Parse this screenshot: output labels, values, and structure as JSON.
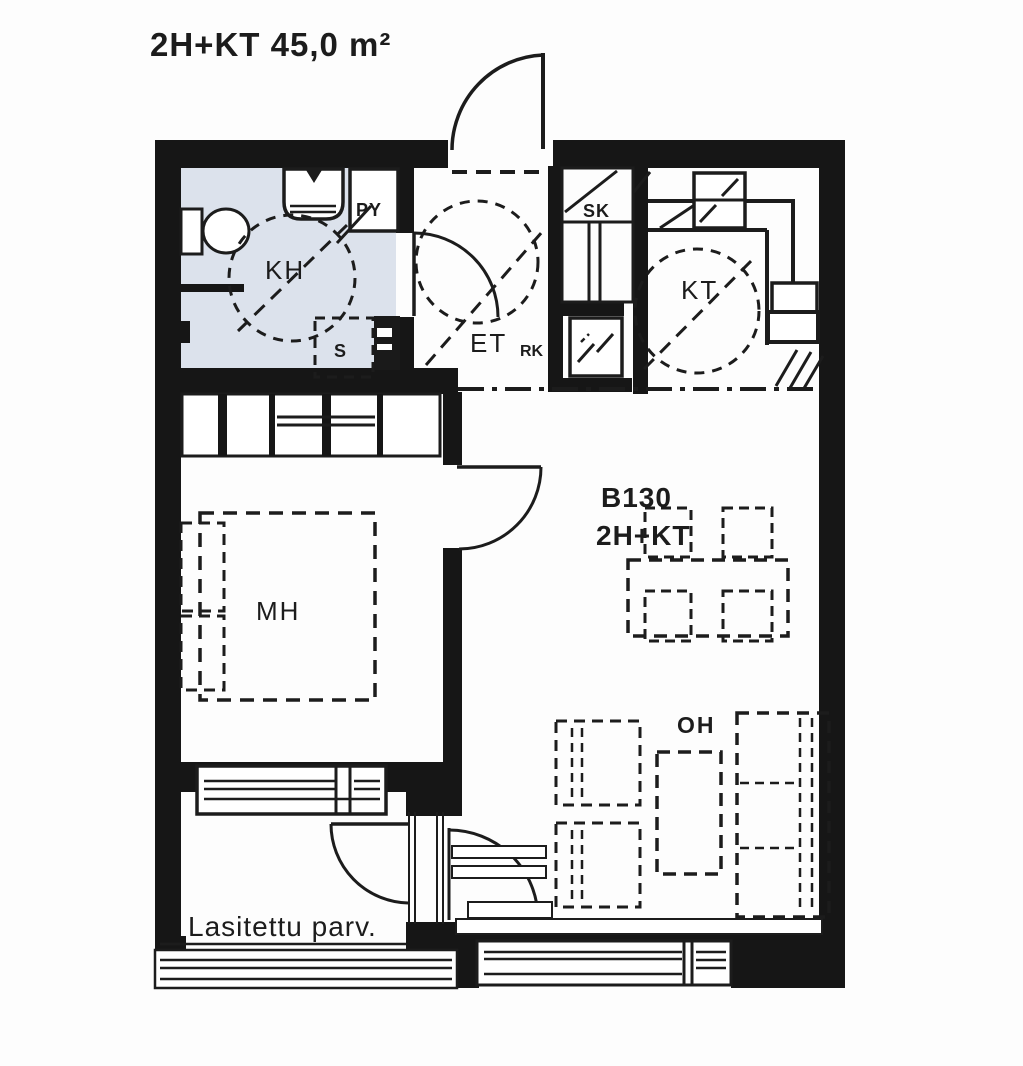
{
  "title": "2H+KT 45,0 m²",
  "unit": {
    "id": "B130",
    "type": "2H+KT"
  },
  "rooms": {
    "bathroom": "KH",
    "washing_machine_spot": "PY",
    "shower_spot": "S",
    "entry_hall": "ET",
    "pantry": "RK",
    "closet": "SK",
    "kitchen": "KT",
    "bedroom": "MH",
    "living_room": "OH",
    "glazed_balcony": "Lasitettu parv."
  },
  "colors": {
    "wall": "#161616",
    "line": "#1c1c1c",
    "bathroom_floor": "#dce2ec",
    "paper": "#fdfdfd"
  }
}
